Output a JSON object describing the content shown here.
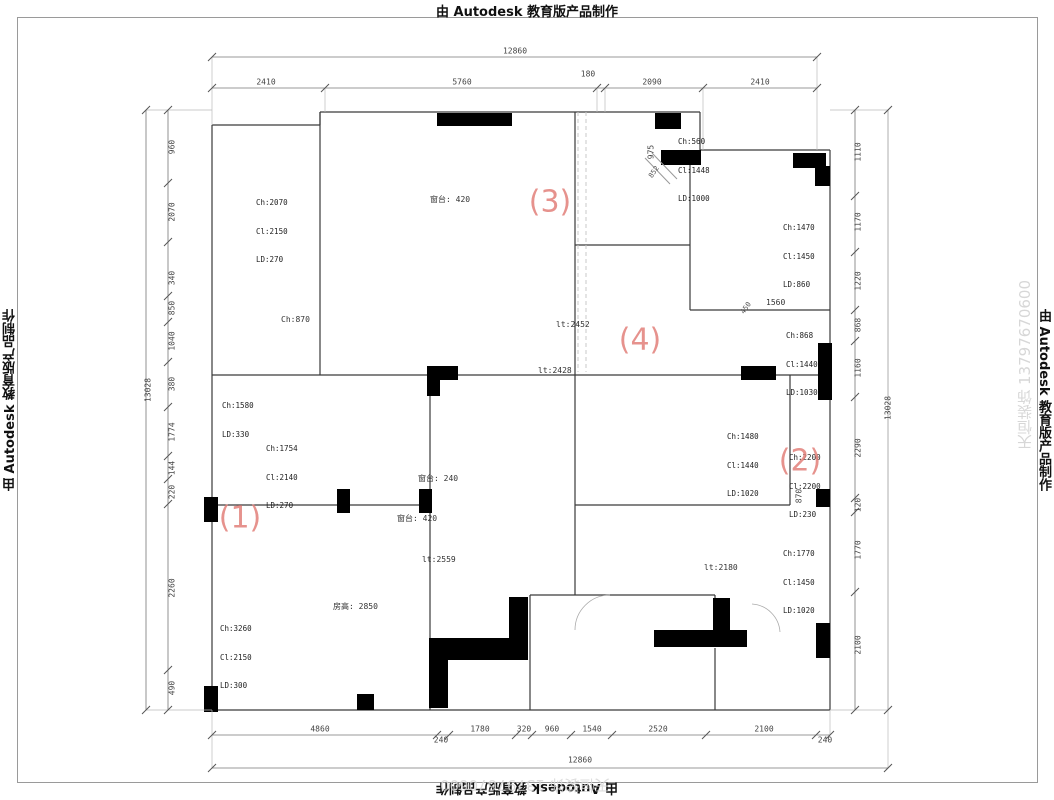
{
  "banner": {
    "text": "由 Autodesk 教育版产品制作"
  },
  "watermark": {
    "text": "天恒装饰 13797670600"
  },
  "marks": {
    "m1": "(1)",
    "m2": "(2)",
    "m3": "(3)",
    "m4": "(4)"
  },
  "dims": {
    "top": {
      "total": "12860",
      "s": [
        "2410",
        "5760",
        "180",
        "2090",
        "2410"
      ]
    },
    "bottom": {
      "total": "12860",
      "s": [
        "4860",
        "240",
        "1780",
        "320",
        "960",
        "1540",
        "2520",
        "2100",
        "240"
      ]
    },
    "left": {
      "total": "13028",
      "s": [
        "960",
        "2070",
        "340",
        "850",
        "1040",
        "380",
        "1774",
        "144",
        "220",
        "2260",
        "490"
      ]
    },
    "right": {
      "total": "13028",
      "s": [
        "1110",
        "1170",
        "1220",
        "868",
        "1160",
        "2290",
        "120",
        "1770",
        "2100"
      ]
    }
  },
  "windows": {
    "tl": {
      "l1": "Ch:2070",
      "l2": "Cl:2150",
      "l3": "LD:270"
    },
    "tr": {
      "l1": "Ch:560",
      "l2": "Cl:1448",
      "l3": "LD:1000"
    },
    "r1": {
      "l1": "Ch:1470",
      "l2": "Cl:1450",
      "l3": "LD:860"
    },
    "r2": {
      "l1": "Ch:868",
      "l2": "Cl:1440",
      "l3": "LD:1030"
    },
    "r3": {
      "l1": "Ch:1480",
      "l2": "Cl:1440",
      "l3": "LD:1020"
    },
    "r4": {
      "l1": "Ch:2200",
      "l2": "Cl:2200",
      "l3": "LD:230"
    },
    "r5": {
      "l1": "Ch:1770",
      "l2": "Cl:1450",
      "l3": "LD:1020"
    },
    "l1": {
      "l1": "Ch:1580",
      "l2": "LD:330",
      "l3": ""
    },
    "l2": {
      "l1": "Ch:1754",
      "l2": "Cl:2140",
      "l3": "LD:270"
    },
    "l3": {
      "l1": "Ch:3260",
      "l2": "Cl:2150",
      "l3": "LD:300"
    }
  },
  "labels": {
    "ch870": "Ch:870",
    "sill_top": "窗台: 420",
    "sill_mid": "窗台: 240",
    "sill_low": "窗台: 420",
    "room_height": "房高: 2850",
    "h2452": "lt:2452",
    "h2428": "lt:2428",
    "h2559": "lt:2559",
    "h2180": "lt:2180",
    "d1560": "1560",
    "d975": "975",
    "d852": "852",
    "d450": "450",
    "d870": "870"
  }
}
